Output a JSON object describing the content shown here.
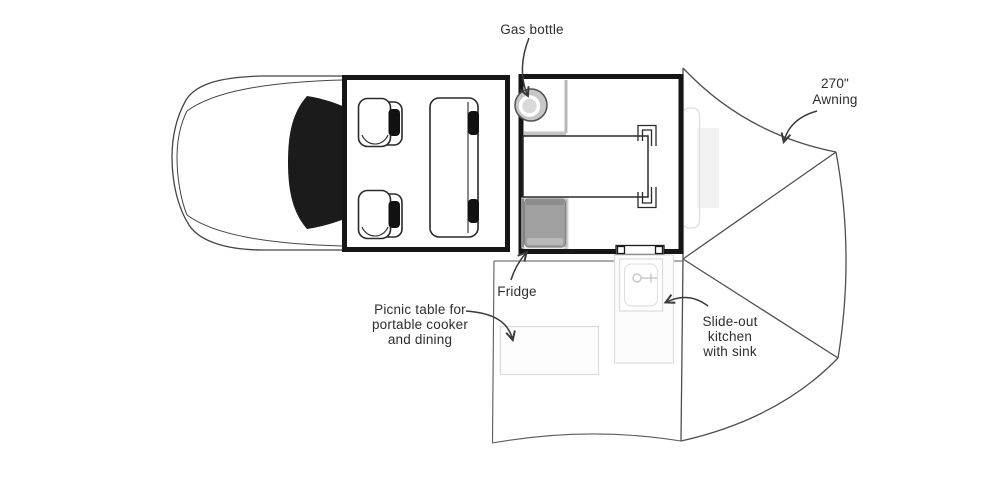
{
  "diagram": {
    "type": "camper-truck-floorplan-top-view",
    "labels": {
      "gas_bottle": "Gas bottle",
      "awning_line1": "270\"",
      "awning_line2": "Awning",
      "fridge": "Fridge",
      "picnic_line1": "Picnic table for",
      "picnic_line2": "portable cooker",
      "picnic_line3": "and dining",
      "kitchen_line1": "Slide-out",
      "kitchen_line2": "kitchen",
      "kitchen_line3": "with sink"
    },
    "colors": {
      "wall": "#161616",
      "outline": "#454545",
      "label_text": "#2e2e2e",
      "windshield": "#1b1b1b",
      "headrest": "#111111",
      "fridge_fill": "#a0a0a0",
      "fridge_top": "#8d8d8d",
      "fridge_bottom": "#b9b9b9",
      "gas_bottle_fill": "#c7c7c7",
      "gas_bottle_inner": "#d9d9d9",
      "partition": "#b8b8b8",
      "light_outline": "#dcdcdc"
    }
  }
}
